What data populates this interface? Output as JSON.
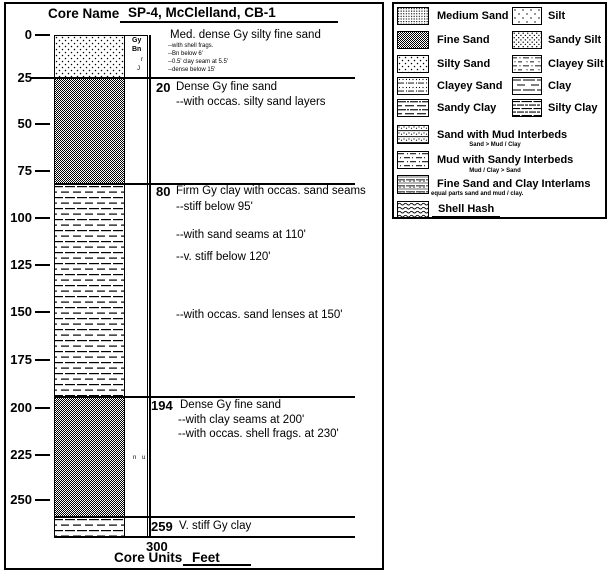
{
  "title": {
    "label": "Core Name",
    "value": "SP-4, McClelland, CB-1"
  },
  "axis": {
    "ticks": [
      "0",
      "25",
      "50",
      "75",
      "100",
      "125",
      "150",
      "175",
      "200",
      "225",
      "250"
    ],
    "total_depth": "300"
  },
  "footer": {
    "label": "Core Units",
    "units": "Feet"
  },
  "color_column": {
    "line1": "Gy",
    "line2": "Bn",
    "mark1": "r",
    "mark2": "J",
    "mid_marks": "n u"
  },
  "intervals": [
    {
      "top_ft": 0,
      "bottom_ft": 20,
      "depth_label": "",
      "lithology": "Silty Sand",
      "title": "Med. dense Gy silty fine sand",
      "notes": [
        "--with shell frags.",
        "--Bn below 6'",
        "--0.5' clay seam at 5.5'",
        "--dense below 15'"
      ]
    },
    {
      "top_ft": 20,
      "bottom_ft": 80,
      "depth_label": "20",
      "lithology": "Fine Sand",
      "title": "Dense Gy fine sand",
      "notes": [
        "--with occas. silty sand layers"
      ]
    },
    {
      "top_ft": 80,
      "bottom_ft": 194,
      "depth_label": "80",
      "lithology": "Clay",
      "title": "Firm Gy clay with occas. sand seams",
      "notes": [
        "--stiff below 95'",
        "--with sand seams at 110'",
        "--v. stiff below 120'",
        "--with occas. sand lenses at 150'"
      ]
    },
    {
      "top_ft": 194,
      "bottom_ft": 259,
      "depth_label": "194",
      "lithology": "Fine Sand",
      "title": "Dense Gy fine sand",
      "notes": [
        "--with clay seams at 200'",
        "--with occas. shell frags. at 230'"
      ]
    },
    {
      "top_ft": 259,
      "bottom_ft": 300,
      "depth_label": "259",
      "lithology": "Clay",
      "title": "V. stiff Gy clay",
      "notes": []
    }
  ],
  "legend": {
    "left": [
      {
        "label": "Medium Sand",
        "pattern": "medium-sand"
      },
      {
        "label": "Fine Sand",
        "pattern": "fine-sand"
      },
      {
        "label": "Silty Sand",
        "pattern": "silty-sand"
      },
      {
        "label": "Clayey Sand",
        "pattern": "clayey-sand"
      },
      {
        "label": "Sandy Clay",
        "pattern": "sandy-clay"
      },
      {
        "label": "Sand with Mud Interbeds",
        "sublabel": "Sand > Mud / Clay",
        "pattern": "sand-with-mud-interbeds"
      },
      {
        "label": "Mud with Sandy Interbeds",
        "sublabel": "Mud / Clay > Sand",
        "pattern": "mud-with-sandy-interbeds"
      },
      {
        "label": "Fine Sand and Clay Interlams",
        "sublabel": "equal parts sand and mud / clay.",
        "pattern": "fine-sand-and-clay-interlams"
      },
      {
        "label": "Shell Hash",
        "pattern": "shell-hash"
      }
    ],
    "right": [
      {
        "label": "Silt",
        "pattern": "silt"
      },
      {
        "label": "Sandy Silt",
        "pattern": "sandy-silt"
      },
      {
        "label": "Clayey Silt",
        "pattern": "clayey-silt"
      },
      {
        "label": "Clay",
        "pattern": "clay"
      },
      {
        "label": "Silty Clay",
        "pattern": "silty-clay"
      }
    ]
  }
}
